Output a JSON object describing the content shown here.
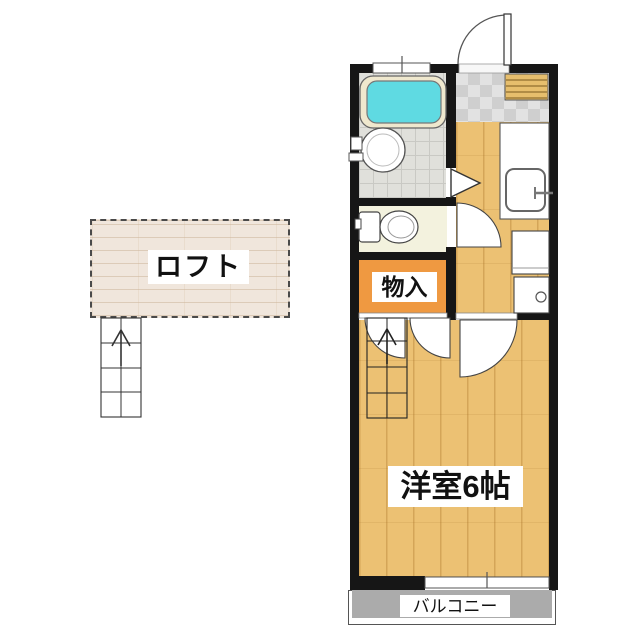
{
  "floorplan": {
    "labels": {
      "loft": "ロフト",
      "storage": "物入",
      "western_room": "洋室6帖",
      "balcony": "バルコニー"
    },
    "colors": {
      "wall": "#161616",
      "wood_floor": "#ECC173",
      "storage_orange": "#EF9941",
      "bathtub_cyan": "#5FDAE2",
      "bathtub_rim": "#EFE8CE",
      "bath_tile": "#E0E0DB",
      "entrance_tile": "#D5D5D5",
      "loft_beige": "#F0E6DC",
      "balcony_gray": "#ABABAB",
      "shoe_cabinet_tan": "#E6BE6D"
    }
  }
}
